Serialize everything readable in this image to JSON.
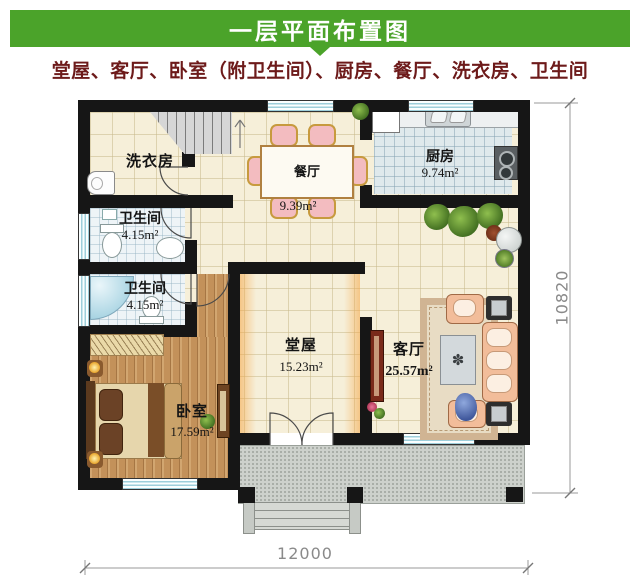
{
  "header": {
    "title": "一层平面布置图",
    "subtitle": "堂屋、客厅、卧室（附卫生间）、厨房、餐厅、洗衣房、卫生间",
    "banner_color": "#4ba32a",
    "subtitle_color": "#6d1a1a"
  },
  "plan": {
    "rooms": [
      {
        "name": "洗衣房",
        "area": ""
      },
      {
        "name": "餐厅",
        "area": "9.39m²"
      },
      {
        "name": "厨房",
        "area": "9.74m²"
      },
      {
        "name": "卫生间",
        "area": "4.15m²"
      },
      {
        "name": "卫生间",
        "area": "4.15m²"
      },
      {
        "name": "堂屋",
        "area": "15.23m²"
      },
      {
        "name": "客厅",
        "area": "25.57m²"
      },
      {
        "name": "卧室",
        "area": "17.59m²"
      }
    ],
    "dimensions": {
      "width": "12000",
      "height": "10820"
    }
  }
}
